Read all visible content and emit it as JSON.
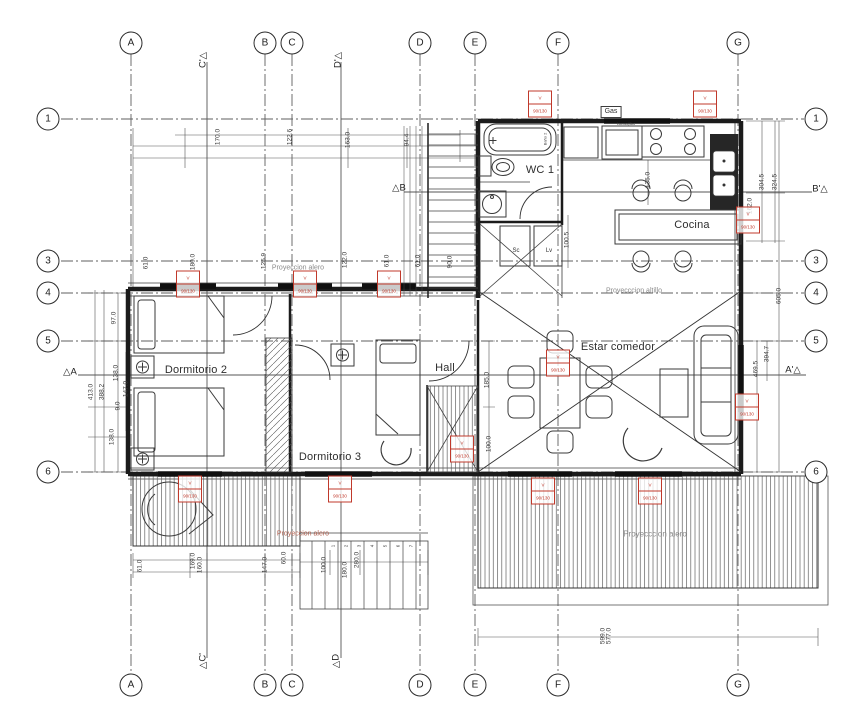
{
  "title": "Planta arquitectura",
  "colors": {
    "line": "#1b1b1b",
    "grid": "#5f5f5f",
    "dim_text": "#3a3a3a",
    "tag_red": "#c0392b",
    "gray_text": "#8a8a8a"
  },
  "bubbles": [
    {
      "t": "A",
      "x": 131,
      "y": 43
    },
    {
      "t": "B",
      "x": 265,
      "y": 43
    },
    {
      "t": "C",
      "x": 292,
      "y": 43
    },
    {
      "t": "D",
      "x": 420,
      "y": 43
    },
    {
      "t": "E",
      "x": 475,
      "y": 43
    },
    {
      "t": "F",
      "x": 558,
      "y": 43
    },
    {
      "t": "G",
      "x": 738,
      "y": 43
    },
    {
      "t": "A",
      "x": 131,
      "y": 685
    },
    {
      "t": "B",
      "x": 265,
      "y": 685
    },
    {
      "t": "C",
      "x": 292,
      "y": 685
    },
    {
      "t": "D",
      "x": 420,
      "y": 685
    },
    {
      "t": "E",
      "x": 475,
      "y": 685
    },
    {
      "t": "F",
      "x": 558,
      "y": 685
    },
    {
      "t": "G",
      "x": 738,
      "y": 685
    },
    {
      "t": "1",
      "x": 48,
      "y": 119
    },
    {
      "t": "3",
      "x": 48,
      "y": 261
    },
    {
      "t": "4",
      "x": 48,
      "y": 293
    },
    {
      "t": "5",
      "x": 48,
      "y": 341
    },
    {
      "t": "6",
      "x": 48,
      "y": 472
    },
    {
      "t": "1",
      "x": 816,
      "y": 119
    },
    {
      "t": "3",
      "x": 816,
      "y": 261
    },
    {
      "t": "4",
      "x": 816,
      "y": 293
    },
    {
      "t": "5",
      "x": 816,
      "y": 341
    },
    {
      "t": "6",
      "x": 816,
      "y": 472
    }
  ],
  "rooms": [
    {
      "t": "WC 1",
      "x": 540,
      "y": 170
    },
    {
      "t": "Cocina",
      "x": 692,
      "y": 225
    },
    {
      "t": "Estar comedor",
      "x": 618,
      "y": 347
    },
    {
      "t": "Dormitorio 2",
      "x": 196,
      "y": 370
    },
    {
      "t": "Dormitorio 3",
      "x": 330,
      "y": 457
    },
    {
      "t": "Hall",
      "x": 445,
      "y": 368
    }
  ],
  "sections": [
    {
      "t": "C'△",
      "x": 203,
      "y": 60,
      "rot": -90
    },
    {
      "t": "D'△",
      "x": 338,
      "y": 60,
      "rot": -90
    },
    {
      "t": "△C'",
      "x": 203,
      "y": 661,
      "rot": -90
    },
    {
      "t": "△D",
      "x": 336,
      "y": 661,
      "rot": -90
    },
    {
      "t": "△B",
      "x": 399,
      "y": 188
    },
    {
      "t": "B'△",
      "x": 820,
      "y": 189
    },
    {
      "t": "△A",
      "x": 70,
      "y": 372
    },
    {
      "t": "A'△",
      "x": 793,
      "y": 370
    }
  ],
  "annotations": [
    {
      "t": "Gas",
      "x": 611,
      "y": 112,
      "fs": 7,
      "boxed": true,
      "c": "#333333"
    },
    {
      "t": "Lavavajillas",
      "x": 626,
      "y": 124,
      "fs": 3.5,
      "c": "#444444"
    },
    {
      "t": "Baño 2",
      "x": 545,
      "y": 139,
      "fs": 4,
      "rot": -90,
      "c": "#444444"
    },
    {
      "t": "Sc",
      "x": 516,
      "y": 251,
      "fs": 6,
      "c": "#333333"
    },
    {
      "t": "Lv",
      "x": 549,
      "y": 251,
      "fs": 6,
      "c": "#333333"
    },
    {
      "t": "Proyeccion alero",
      "x": 298,
      "y": 268,
      "fs": 7,
      "c": "#8a8a8a"
    },
    {
      "t": "Proyeccion alero",
      "x": 303,
      "y": 534,
      "fs": 7,
      "c": "#b0604f"
    },
    {
      "t": "Proyecccion alero",
      "x": 655,
      "y": 534,
      "fs": 8,
      "c": "#8a8a8a"
    },
    {
      "t": "Proyecccion altillo",
      "x": 634,
      "y": 291,
      "fs": 7,
      "c": "#8a8a8a"
    }
  ],
  "dims": [
    {
      "t": "170.0",
      "x": 218,
      "y": 137
    },
    {
      "t": "122.6",
      "x": 290,
      "y": 137
    },
    {
      "t": "163.0",
      "x": 348,
      "y": 140
    },
    {
      "t": "94.4",
      "x": 407,
      "y": 140
    },
    {
      "t": "304.5",
      "x": 762,
      "y": 182
    },
    {
      "t": "324.5",
      "x": 775,
      "y": 182
    },
    {
      "t": "162.0",
      "x": 750,
      "y": 206
    },
    {
      "t": "135.0",
      "x": 648,
      "y": 180
    },
    {
      "t": "605.0",
      "x": 779,
      "y": 296
    },
    {
      "t": "394.7",
      "x": 767,
      "y": 354
    },
    {
      "t": "469.5",
      "x": 756,
      "y": 369
    },
    {
      "t": "100.5",
      "x": 567,
      "y": 240
    },
    {
      "t": "97.0",
      "x": 114,
      "y": 318
    },
    {
      "t": "413.0",
      "x": 91,
      "y": 392
    },
    {
      "t": "388.2",
      "x": 102,
      "y": 392
    },
    {
      "t": "138.0",
      "x": 116,
      "y": 373
    },
    {
      "t": "147.0",
      "x": 126,
      "y": 389
    },
    {
      "t": "9.0",
      "x": 118,
      "y": 406
    },
    {
      "t": "138.0",
      "x": 112,
      "y": 437
    },
    {
      "t": "61.0",
      "x": 146,
      "y": 263
    },
    {
      "t": "180.0",
      "x": 193,
      "y": 262
    },
    {
      "t": "125.9",
      "x": 264,
      "y": 261
    },
    {
      "t": "122.0",
      "x": 345,
      "y": 260
    },
    {
      "t": "61.0",
      "x": 387,
      "y": 261
    },
    {
      "t": "61.0",
      "x": 418,
      "y": 261
    },
    {
      "t": "90.0",
      "x": 450,
      "y": 262
    },
    {
      "t": "61.0",
      "x": 140,
      "y": 566
    },
    {
      "t": "169.0",
      "x": 193,
      "y": 561
    },
    {
      "t": "160.0",
      "x": 200,
      "y": 565
    },
    {
      "t": "147.0",
      "x": 265,
      "y": 565
    },
    {
      "t": "60.0",
      "x": 284,
      "y": 558
    },
    {
      "t": "100.0",
      "x": 324,
      "y": 565
    },
    {
      "t": "180.0",
      "x": 345,
      "y": 570
    },
    {
      "t": "280.0",
      "x": 357,
      "y": 560
    },
    {
      "t": "599.0",
      "x": 603,
      "y": 636
    },
    {
      "t": "577.0",
      "x": 609,
      "y": 636
    },
    {
      "t": "185.0",
      "x": 487,
      "y": 380
    },
    {
      "t": "100.0",
      "x": 489,
      "y": 444
    },
    {
      "t": "1",
      "x": 333,
      "y": 546,
      "fs": 4.5
    },
    {
      "t": "2",
      "x": 346,
      "y": 546,
      "fs": 4.5
    },
    {
      "t": "3",
      "x": 359,
      "y": 546,
      "fs": 4.5
    },
    {
      "t": "4",
      "x": 372,
      "y": 546,
      "fs": 4.5
    },
    {
      "t": "5",
      "x": 385,
      "y": 546,
      "fs": 4.5
    },
    {
      "t": "6",
      "x": 398,
      "y": 546,
      "fs": 4.5
    },
    {
      "t": "7",
      "x": 411,
      "y": 546,
      "fs": 4.5
    }
  ],
  "tags": [
    {
      "l1": "V",
      "l2": "90/130",
      "x": 540,
      "y": 104
    },
    {
      "l1": "V",
      "l2": "90/130",
      "x": 705,
      "y": 104
    },
    {
      "l1": "V",
      "l2": "90/130",
      "x": 748,
      "y": 220
    },
    {
      "l1": "V",
      "l2": "90/130",
      "x": 747,
      "y": 407
    },
    {
      "l1": "V",
      "l2": "90/130",
      "x": 188,
      "y": 284
    },
    {
      "l1": "V",
      "l2": "90/130",
      "x": 305,
      "y": 284
    },
    {
      "l1": "V",
      "l2": "90/130",
      "x": 389,
      "y": 284
    },
    {
      "l1": "V",
      "l2": "90/130",
      "x": 462,
      "y": 449
    },
    {
      "l1": "V",
      "l2": "90/130",
      "x": 558,
      "y": 363
    },
    {
      "l1": "V",
      "l2": "90/130",
      "x": 190,
      "y": 489
    },
    {
      "l1": "V",
      "l2": "90/130",
      "x": 340,
      "y": 489
    },
    {
      "l1": "V",
      "l2": "90/130",
      "x": 543,
      "y": 491
    },
    {
      "l1": "V",
      "l2": "90/130",
      "x": 650,
      "y": 491
    }
  ]
}
